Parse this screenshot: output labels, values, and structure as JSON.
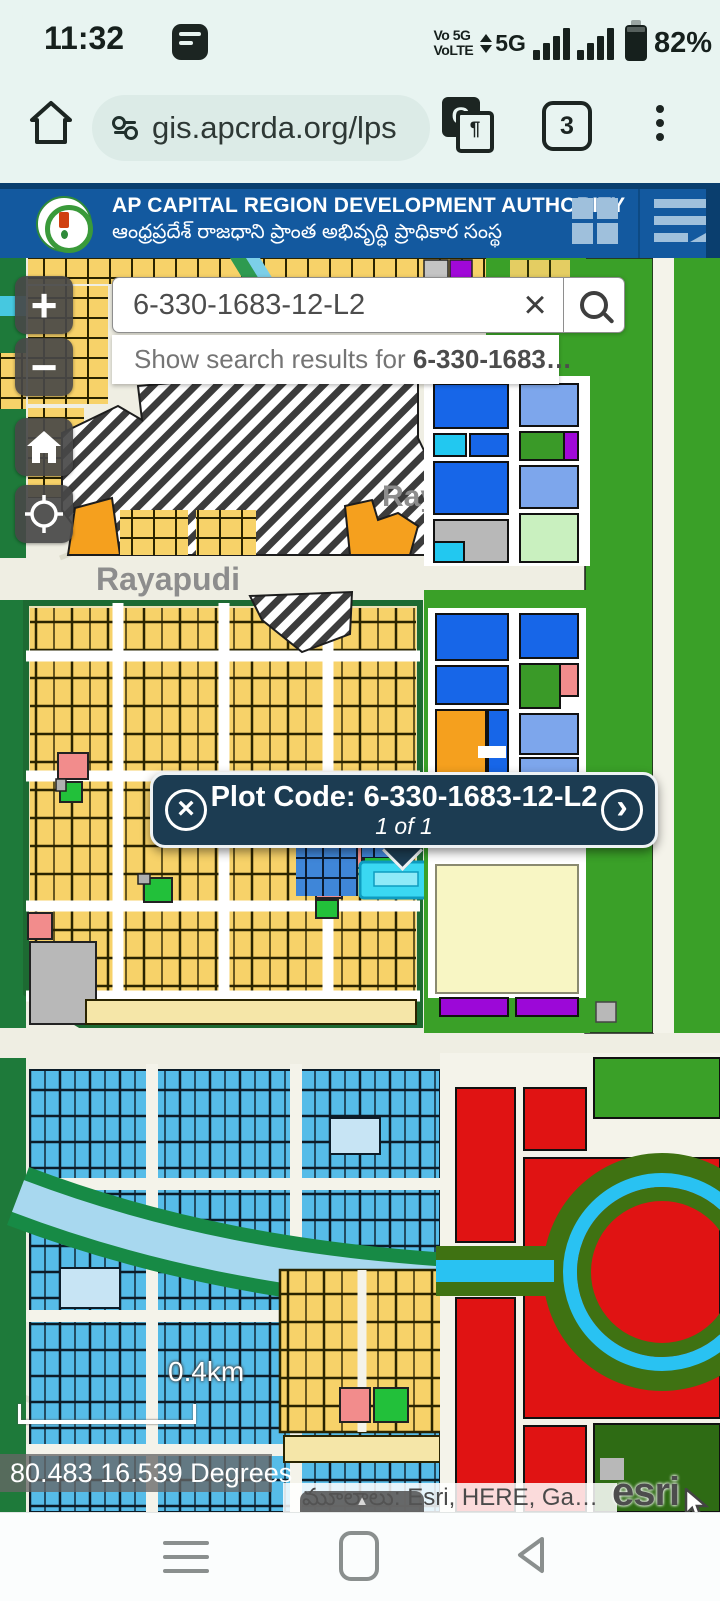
{
  "status_bar": {
    "time": "11:32",
    "carrier_line1": "Vo 5G",
    "carrier_line2": "VoLTE",
    "network": "5G",
    "battery": "82%",
    "translate_glyph": "G"
  },
  "browser": {
    "url": "gis.apcrda.org/lps",
    "tabs": "3",
    "translate_glyph": "G",
    "translate_glyph2": "¶"
  },
  "header": {
    "title": "AP CAPITAL REGION DEVELOPMENT AUTHORITY",
    "subtitle": "ఆంధ్రప్రదేశ్ రాజధాని ప్రాంత అభివృద్ధి ప్రాధికార సంస్థ"
  },
  "controls": {
    "zoom_in": "+",
    "zoom_out": "−"
  },
  "search": {
    "value": "6-330-1683-12-L2",
    "clear_icon": "×",
    "suggestion_prefix": "Show search results for ",
    "suggestion_term": "6-330-1683…"
  },
  "popup": {
    "close_icon": "×",
    "title": "Plot Code: 6-330-1683-12-L2",
    "pager": "1 of 1",
    "next_icon": "›"
  },
  "map": {
    "town_label": "Rayapudi",
    "town_label_partial": "Ray",
    "scale_label": "0.4km",
    "coordinates": "80.483 16.539 Degrees",
    "attribution": "మూలాలు: Esri, HERE, Ga…",
    "esri": "esri",
    "expand_icon": "▲"
  },
  "colors": {
    "header_blue": "#13599f",
    "popup_bg": "#1c3c52",
    "plot_yellow": "#f7d269",
    "plot_sky_blue": "#56bce8",
    "selected_plot_cyan": "#3ad8f2",
    "zone_green": "#3aa028",
    "zone_dark_green": "#1e7a3a",
    "zone_red": "#e01313",
    "zone_orange": "#f5a01e",
    "zone_purple": "#a008d8",
    "zone_pink": "#f28c8c",
    "zone_blue": "#1766e8",
    "canal_blue": "#a8d8ef"
  }
}
